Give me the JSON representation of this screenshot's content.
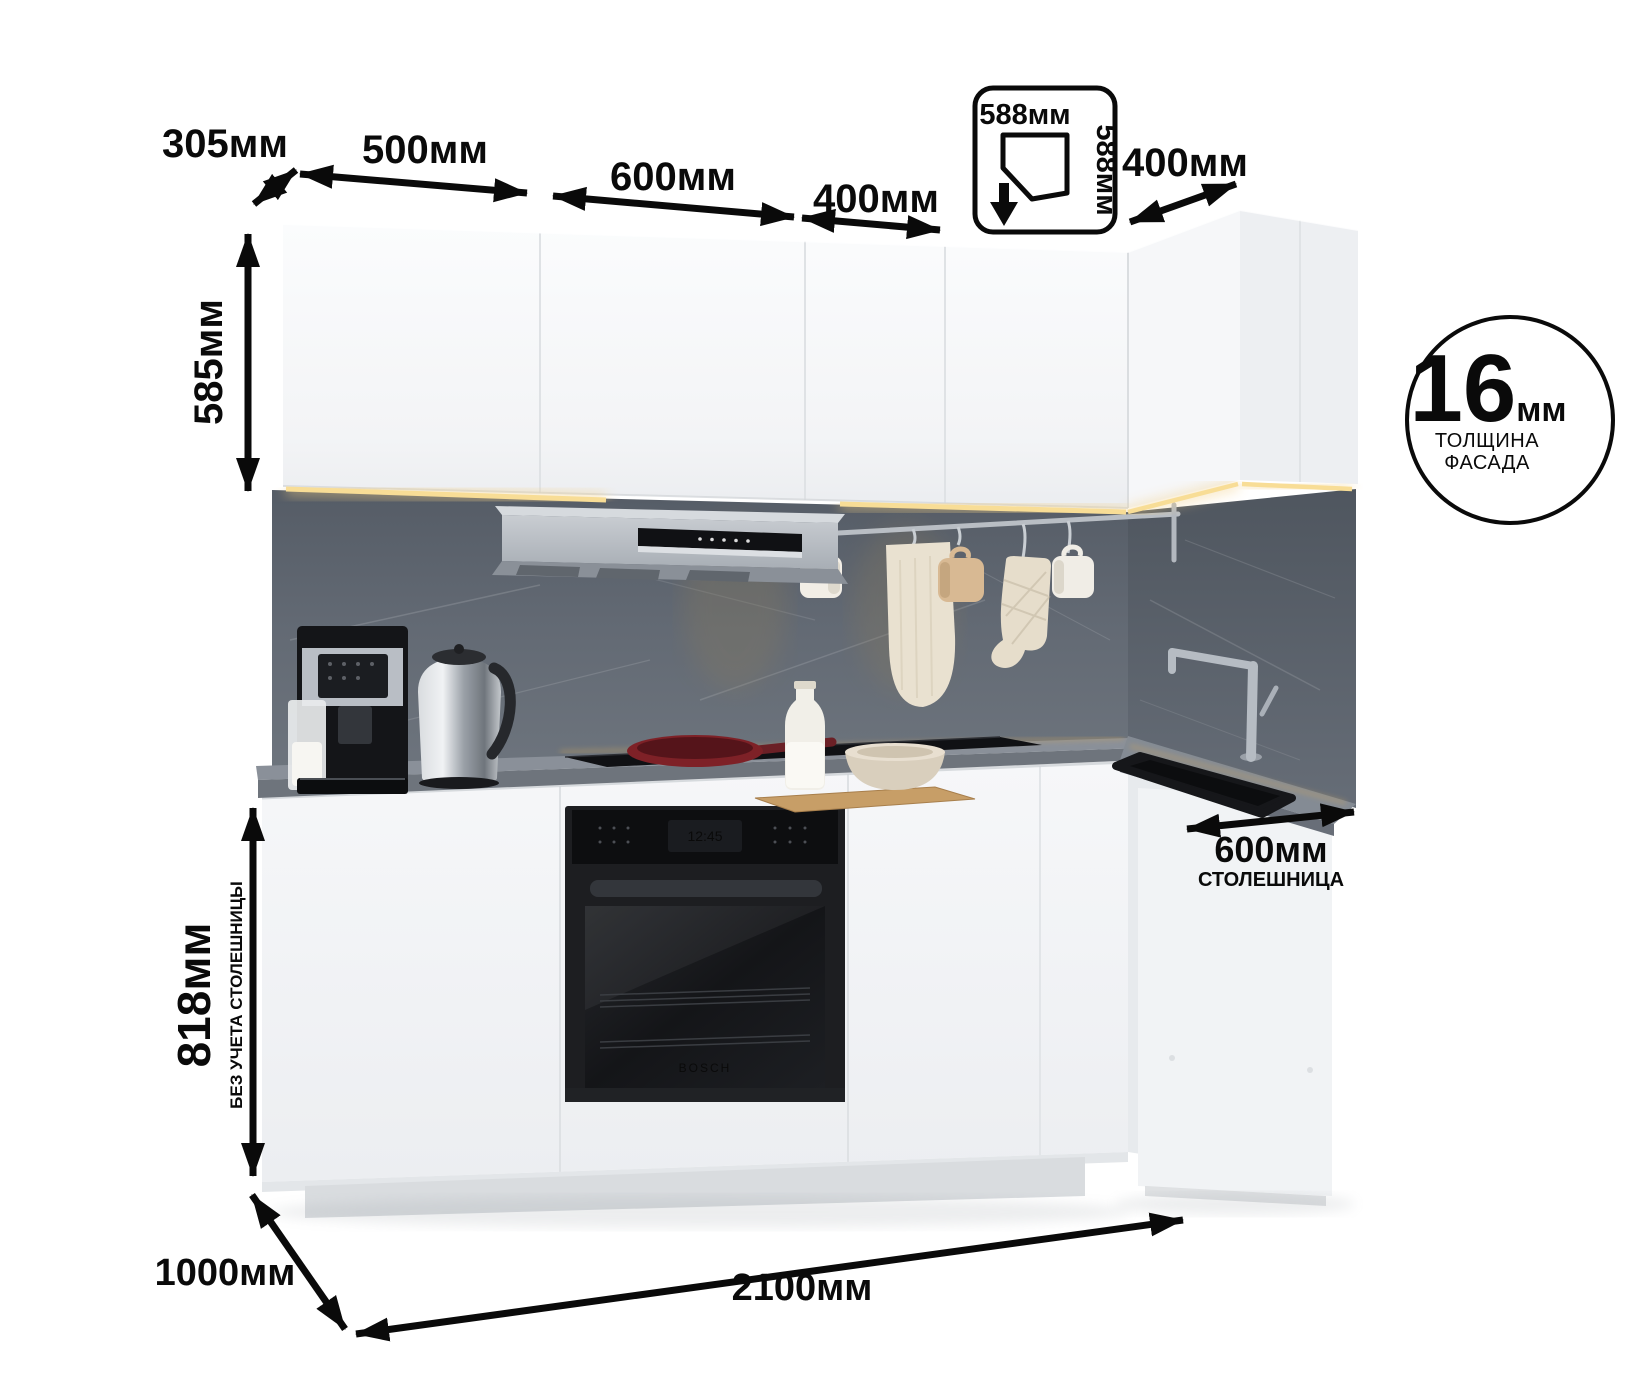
{
  "annotations": {
    "top_dims": {
      "d305": "305мм",
      "d500": "500мм",
      "d600": "600мм",
      "d400": "400мм"
    },
    "right_dims": {
      "d400": "400мм",
      "d600": "600мм",
      "d600_note": "СТОЛЕШНИЦА"
    },
    "left_dims": {
      "d585": "585мм",
      "d818": "818мм",
      "d818_note": "БЕЗ УЧЕТА СТОЛЕШНИЦЫ"
    },
    "bottom_dims": {
      "d1000": "1000мм",
      "d2100": "2100мм"
    },
    "corner_icon": {
      "width": "588мм",
      "depth": "588мм"
    },
    "facade_badge": {
      "value": "16",
      "unit": "мм",
      "caption_line1": "ТОЛЩИНА",
      "caption_line2": "ФАСАДА"
    }
  },
  "scene": {
    "oven_display": "12:45",
    "oven_brand": "BOSCH"
  },
  "colors": {
    "annotation_black": "#0a0a0a",
    "cabinet_white": "#f4f5f7",
    "backsplash_gray": "#646b74",
    "countertop_gray": "#858c95",
    "led_glow": "#f3cf7e",
    "hood_silver": "#b7bcc2",
    "appliance_black": "#17181b",
    "pan_red": "#7e2127"
  }
}
